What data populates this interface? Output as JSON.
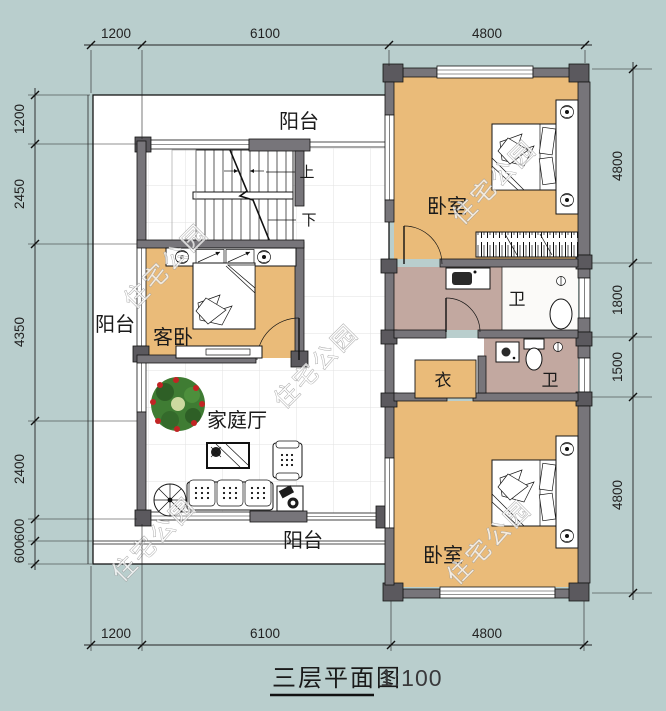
{
  "title": {
    "text": "三层平面图",
    "scale": "1:100"
  },
  "watermark": {
    "text": "住宅公园"
  },
  "dimensions": {
    "top": [
      "1200",
      "6100",
      "4800"
    ],
    "bottom": [
      "1200",
      "6100",
      "4800"
    ],
    "left": [
      "1200",
      "2450",
      "4350",
      "2400",
      "600",
      "600"
    ],
    "right": [
      "4800",
      "1800",
      "1500",
      "4800"
    ]
  },
  "rooms": {
    "balcony_top": "阳台",
    "balcony_left": "阳台",
    "balcony_bottom": "阳台",
    "bedroom_top": "卧室",
    "bedroom_bottom": "卧室",
    "guest_bedroom": "客卧",
    "family_hall": "家庭厅",
    "bath_top": "卫",
    "bath_bottom": "卫",
    "closet": "衣",
    "stair_up": "上",
    "stair_down": "下"
  },
  "colors": {
    "background": "#b9cecd",
    "room_floor": "#eabb79",
    "bath_floor": "#c2a8a0",
    "wall": "#77757a",
    "column": "#5b595e"
  }
}
